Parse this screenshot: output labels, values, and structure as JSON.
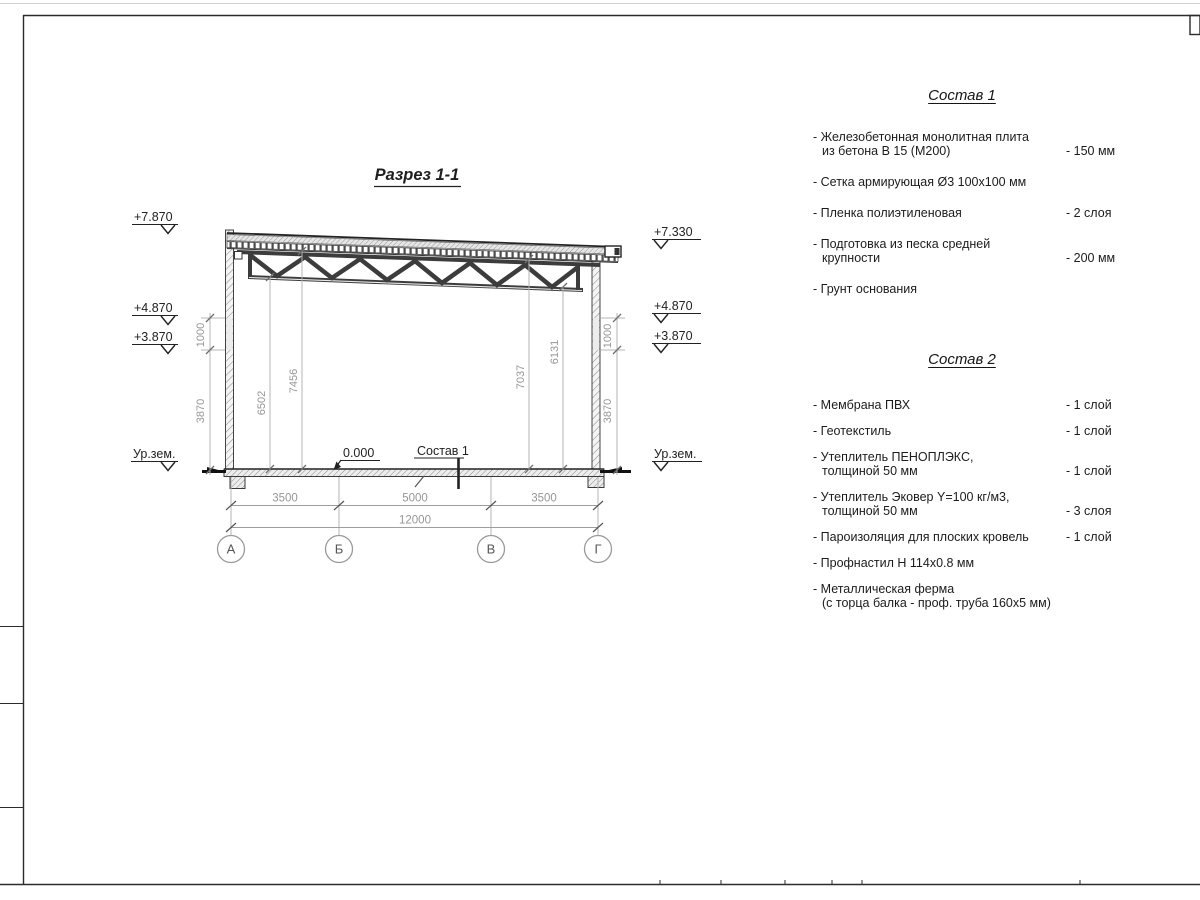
{
  "sheet": {
    "section": {
      "title": "Разрез 1-1",
      "elevations_left": [
        "+7.870",
        "+4.870",
        "+3.870",
        "Ур.зем."
      ],
      "elevations_right": [
        "+7.330",
        "+4.870",
        "+3.870",
        "Ур.зем."
      ],
      "dims": {
        "left_1000": "1000",
        "left_3870": "3870",
        "right_1000": "1000",
        "right_3870": "3870",
        "h_6502": "6502",
        "h_7456": "7456",
        "h_7037": "7037",
        "h_6131": "6131",
        "span_1": "3500",
        "span_2": "5000",
        "span_3": "3500",
        "total": "12000"
      },
      "zero_level": "0.000",
      "floor_callout": "Состав 1",
      "axes": [
        "А",
        "Б",
        "В",
        "Г"
      ]
    },
    "compositions": [
      {
        "title": "Состав 1",
        "items": [
          {
            "text": "- Железобетонная  монолитная плита\nиз бетона В 15 (М200)",
            "value": "- 150 мм"
          },
          {
            "text": "- Сетка армирующая Ø3 100x100 мм",
            "value": ""
          },
          {
            "text": "- Пленка полиэтиленовая",
            "value": "- 2 слоя"
          },
          {
            "text": "- Подготовка из песка средней\nкрупности",
            "value": "- 200 мм"
          },
          {
            "text": "- Грунт основания",
            "value": ""
          }
        ]
      },
      {
        "title": "Состав 2",
        "items": [
          {
            "text": "- Мембрана ПВХ",
            "value": "- 1 слой"
          },
          {
            "text": "- Геотекстиль",
            "value": "- 1 слой"
          },
          {
            "text": "- Утеплитель ПЕНОПЛЭКС,\nтолщиной 50 мм",
            "value": "- 1 слой"
          },
          {
            "text": "- Утеплитель Эковер Y=100 кг/м3,\nтолщиной 50 мм",
            "value": "- 3 слоя"
          },
          {
            "text": "- Пароизоляция для плоских кровель",
            "value": "- 1 слой"
          },
          {
            "text": "- Профнастил Н 114x0.8 мм",
            "value": ""
          },
          {
            "text": "- Металлическая ферма\n(с торца балка - проф. труба 160х5 мм)",
            "value": ""
          }
        ]
      }
    ],
    "colors": {
      "line": "#2b2b2b",
      "dim_text": "#969696",
      "text": "#1a1a1a"
    }
  }
}
